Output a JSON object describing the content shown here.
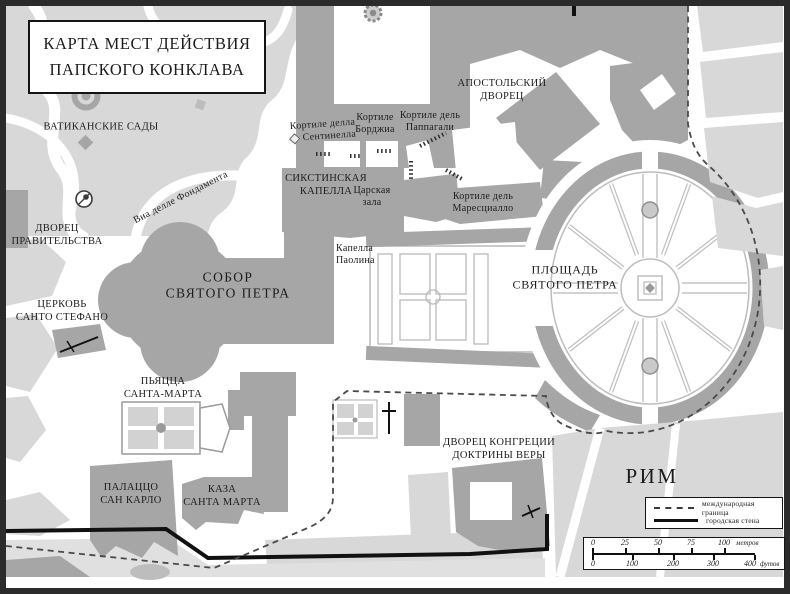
{
  "title": {
    "line1": "КАРТА МЕСТ ДЕЙСТВИЯ",
    "line2": "ПАПСКОГО КОНКЛАВА"
  },
  "labels": {
    "vatican_gardens": "ВАТИКАНСКИЕ САДЫ",
    "apostolic_palace": {
      "line1": "АПОСТОЛЬСКИЙ",
      "line2": "ДВОРЕЦ"
    },
    "cortile_sentinella": {
      "line1": "Кортиле делла",
      "line2": "Сентинелла"
    },
    "cortile_borgia": {
      "line1": "Кортиле",
      "line2": "Борджиа"
    },
    "cortile_pappagali": {
      "line1": "Кортиле дель",
      "line2": "Паппагали"
    },
    "sistine_chapel": {
      "line1": "СИКСТИНСКАЯ",
      "line2": "КАПЕЛЛА"
    },
    "royal_hall": {
      "line1": "Царская",
      "line2": "зала"
    },
    "cortile_maresciallo": {
      "line1": "Кортиле дель",
      "line2": "Маресциалло"
    },
    "via_fondamenta": "Виа делле Фондамента",
    "government_palace": {
      "line1": "ДВОРЕЦ",
      "line2": "ПРАВИТЕЛЬСТВА"
    },
    "pauline_chapel": {
      "line1": "Капелла",
      "line2": "Паолина"
    },
    "st_peters_basilica": {
      "line1": "СОБОР",
      "line2": "СВЯТОГО ПЕТРА"
    },
    "st_peters_square": {
      "line1": "ПЛОЩАДЬ",
      "line2": "СВЯТОГО ПЕТРА"
    },
    "santo_stefano": {
      "line1": "ЦЕРКОВЬ",
      "line2": "САНТО СТЕФАНО"
    },
    "piazza_santa_marta": {
      "line1": "ПЬЯЦЦА",
      "line2": "САНТА-МАРТА"
    },
    "congregation_palace": {
      "line1": "ДВОРЕЦ КОНГРЕЦИИ",
      "line2": "ДОКТРИНЫ ВЕРЫ"
    },
    "palazzo_san_carlo": {
      "line1": "ПАЛАЦЦО",
      "line2": "САН КАРЛО"
    },
    "casa_santa_marta": {
      "line1": "КАЗА",
      "line2": "САНТА МАРТА"
    },
    "rome": "РИМ"
  },
  "legend": {
    "international_border": "международная граница",
    "city_wall": "городская стена"
  },
  "scale_bar": {
    "meters": {
      "t0": "0",
      "t1": "25",
      "t2": "50",
      "t3": "75",
      "t4": "100",
      "unit": "метров"
    },
    "feet": {
      "t0": "0",
      "t1": "100",
      "t2": "200",
      "t3": "300",
      "t4": "400",
      "unit": "футов"
    }
  },
  "colors": {
    "building": "#a6a6a6",
    "open_space": "#d8d8d8",
    "background": "#ffffff",
    "ink": "#1c1c1c"
  }
}
